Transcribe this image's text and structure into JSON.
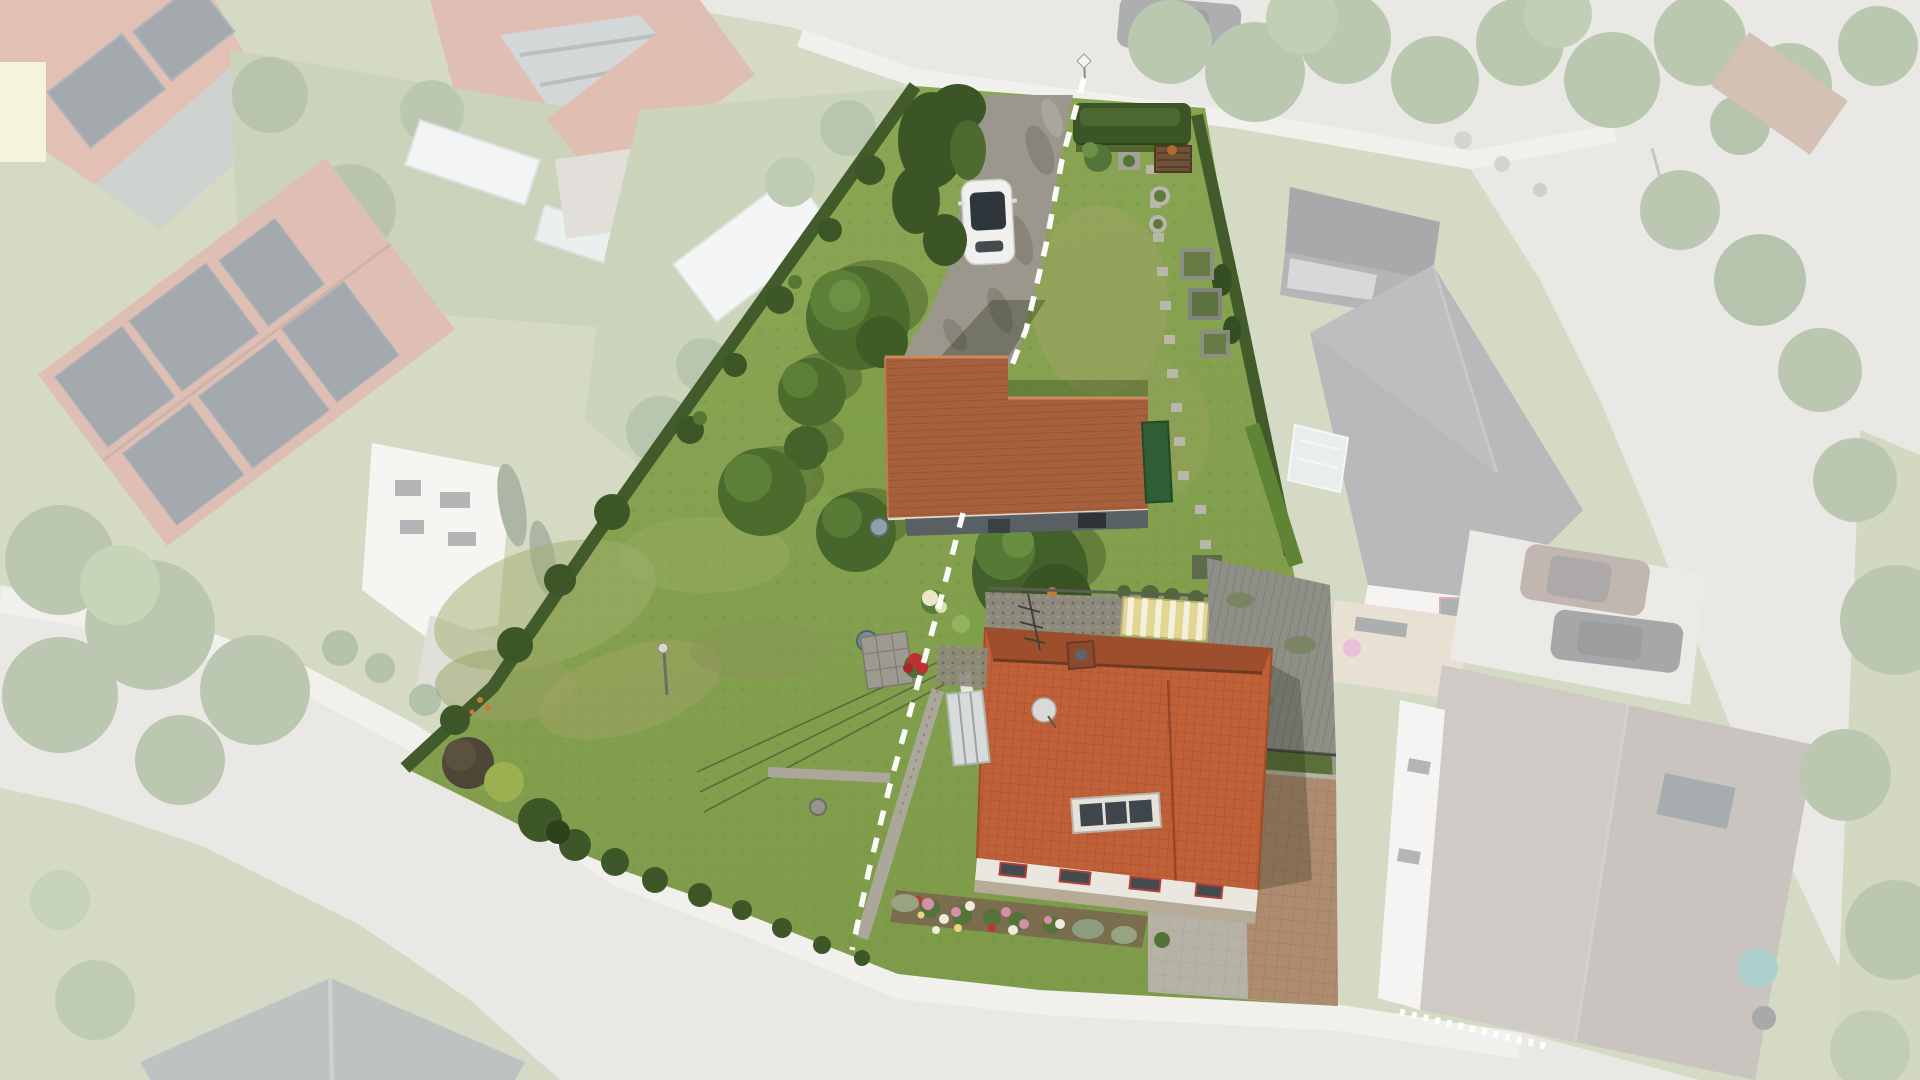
{
  "meta": {
    "image_type": "aerial-drone-photograph",
    "description": "Bird's-eye real-estate photo of a long residential parcel highlighted in full colour while all surrounding houses, gardens and streets are faded under a white wash. A white dashed line splits the parcel into two lots. Inside: lawn, gravel drive with a white car, red-tiled barn, red hip-roof house with satellite dish, flower beds, hedges and garden beds.",
    "visible_text": ""
  },
  "palette": {
    "lawn_top": "#8CA855",
    "lawn_bottom": "#7E9B4A",
    "lawn_dry": "#A5A468",
    "grass_outside": "#9AA873",
    "hedge": "#3E5827",
    "tree": "#4C6C2E",
    "tree_light": "#699140",
    "gravel": "#9B978C",
    "road": "#CDC9C2",
    "sidewalk": "#DEDBD5",
    "barn_roof": "#A7603C",
    "house_roof": "#C06038",
    "house_roof_shadow": "#9D4E2C",
    "wall_white": "#EAE7E0",
    "neighbor_dark_roof": "#55595B",
    "corrugated_gray": "#8F8F88",
    "awning_yellow": "#E3D592",
    "car_white": "#F0F1EF",
    "glass_dark": "#2F363B",
    "brick_paving": "#AE8A6F",
    "gray_paving": "#B7B2A6",
    "flowerbed_soil": "#7A6A4F",
    "flower_pink": "#D590A8",
    "flower_white": "#EFECDC",
    "flower_red": "#C23434",
    "solar_panel": "#26323E"
  },
  "plot": {
    "polygon_points": "915,86 1205,108 1237,300 1290,555 1332,760 1338,1006 1040,990 898,974 756,918 616,868 545,838 470,800 405,768 493,687 593,540 637,477",
    "divider_path": "M1084,78 L1062,160 L1046,245 L1026,330 L1010,370 M963,513 L938,610 L912,705 L890,785 L869,870 L852,950",
    "divider_color": "#FFFFFF",
    "overlay_color": "#FFFFFF",
    "overlay_opacity": "0.58"
  },
  "scene": {
    "highlighted_parcel": [
      "lawn",
      "gravel driveway with parked white car",
      "clipped hedges along street and boundaries",
      "red tiled barn / outbuilding",
      "red hip-roof dwelling with dormer, chimney, antenna and satellite dish",
      "rose flower bed",
      "stone garden path",
      "vegetable beds, compost bins and stepping stones",
      "weathered gray shed roof",
      "yellow striped awning",
      "paved courtyard and brick drive"
    ],
    "faded_surroundings": [
      "street junction at top with roadside trees and parked dark car",
      "large neighbour roofs with solar panels on the left",
      "neighbour house with white facade and terrace",
      "gable house with dark roof on the right",
      "second neighbour house with brown roof, two parked cars and white fence at bottom right",
      "curved village road with pavements at bottom left"
    ]
  }
}
